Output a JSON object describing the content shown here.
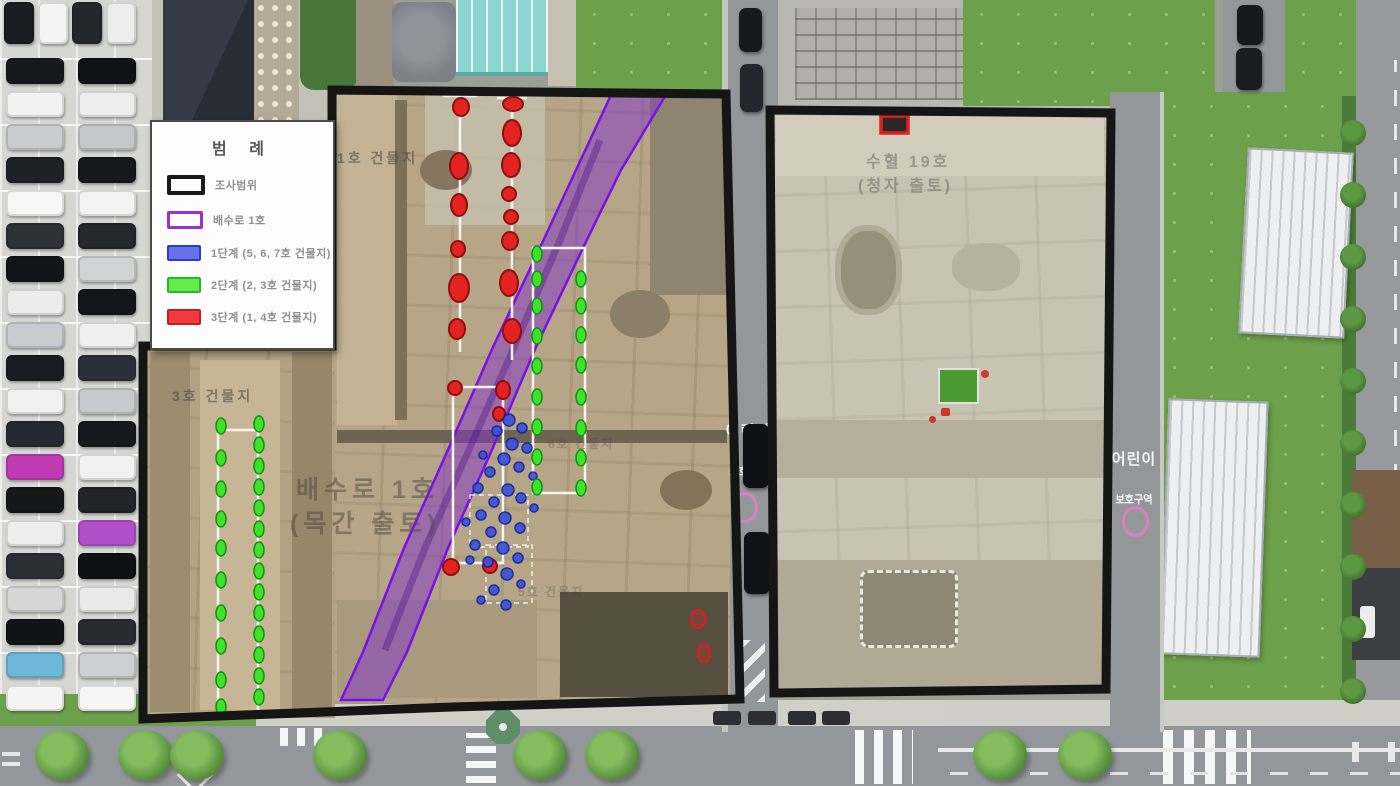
{
  "legend": {
    "title": "범 례",
    "items": [
      {
        "id": "survey-area",
        "label": "조사범위",
        "fill": "#ffffff",
        "border": "#1a1a1a",
        "border_px": 4
      },
      {
        "id": "drain-no1",
        "label": "배수로 1호",
        "fill": "#ffffff",
        "border": "#9b30d9",
        "border_px": 3
      },
      {
        "id": "stage-1",
        "label": "1단계 (5, 6, 7호 건물지)",
        "fill": "#6673e8",
        "border": "#2c3bd0",
        "border_px": 2
      },
      {
        "id": "stage-2",
        "label": "2단계 (2, 3호 건물지)",
        "fill": "#63ec4a",
        "border": "#28b828",
        "border_px": 2
      },
      {
        "id": "stage-3",
        "label": "3단계 (1, 4호 건물지)",
        "fill": "#f23c3c",
        "border": "#c41d1d",
        "border_px": 2
      }
    ]
  },
  "site_labels": {
    "building_1": "1호 건물지",
    "building_3": "3호 건물지",
    "building_5": "5호 건물지",
    "building_6": "6호 건물지",
    "drain_name": "배수로 1호",
    "drain_note": "(목간 출토)",
    "pit_name": "수혈 19호",
    "pit_note": "(청자 출토)"
  },
  "road_text": {
    "line1": "어린이",
    "line2": "보호구역"
  },
  "colors": {
    "survey_outline": "#151515",
    "drain_purple_fill": "rgba(128,50,200,0.5)",
    "drain_purple_stroke": "#7a10e8",
    "stage1_blue_fill": "#3a52d5",
    "stage1_blue_stroke": "#14229e",
    "stage2_green_fill": "#3ce32a",
    "stage2_green_stroke": "#149114",
    "stage3_red_fill": "#e32222",
    "stage3_red_stroke": "#8f0f0f",
    "white_grid": "#f5f5f5"
  },
  "scene": {
    "parking_top_row": [
      "#1b1d22",
      "#f4f4f4",
      "#23262b",
      "#ededed"
    ],
    "parking_col1": [
      "#16181c",
      "#f2f2f2",
      "#c9cbcd",
      "#1d2026",
      "#f6f6f6",
      "#2e3138",
      "#121418",
      "#ececec",
      "#c9cbce",
      "#191b20",
      "#f0f0f0",
      "#26292f",
      "#c03ab5",
      "#15171b",
      "#eeeeee",
      "#2b2e34",
      "#d6d6d6",
      "#111316",
      "#6fb7d8",
      "#f4f4f4"
    ],
    "parking_col2": [
      "#101215",
      "#ededed",
      "#c5c7c9",
      "#17191d",
      "#f3f3f3",
      "#24272c",
      "#d0d2d4",
      "#131518",
      "#efefef",
      "#2c2f35",
      "#c7c9cb",
      "#16181b",
      "#f1f1f1",
      "#212429",
      "#b14fc9",
      "#0f1113",
      "#e9e9e9",
      "#282b31",
      "#cdcfd1",
      "#f5f5f5"
    ],
    "street_trees_x": [
      62,
      145,
      197,
      340,
      540,
      612,
      1000,
      1085
    ],
    "road_cars": [
      "#17191d",
      "#23262c",
      "#0f1114",
      "#101215",
      "#17191d",
      "#1a1c20"
    ]
  }
}
